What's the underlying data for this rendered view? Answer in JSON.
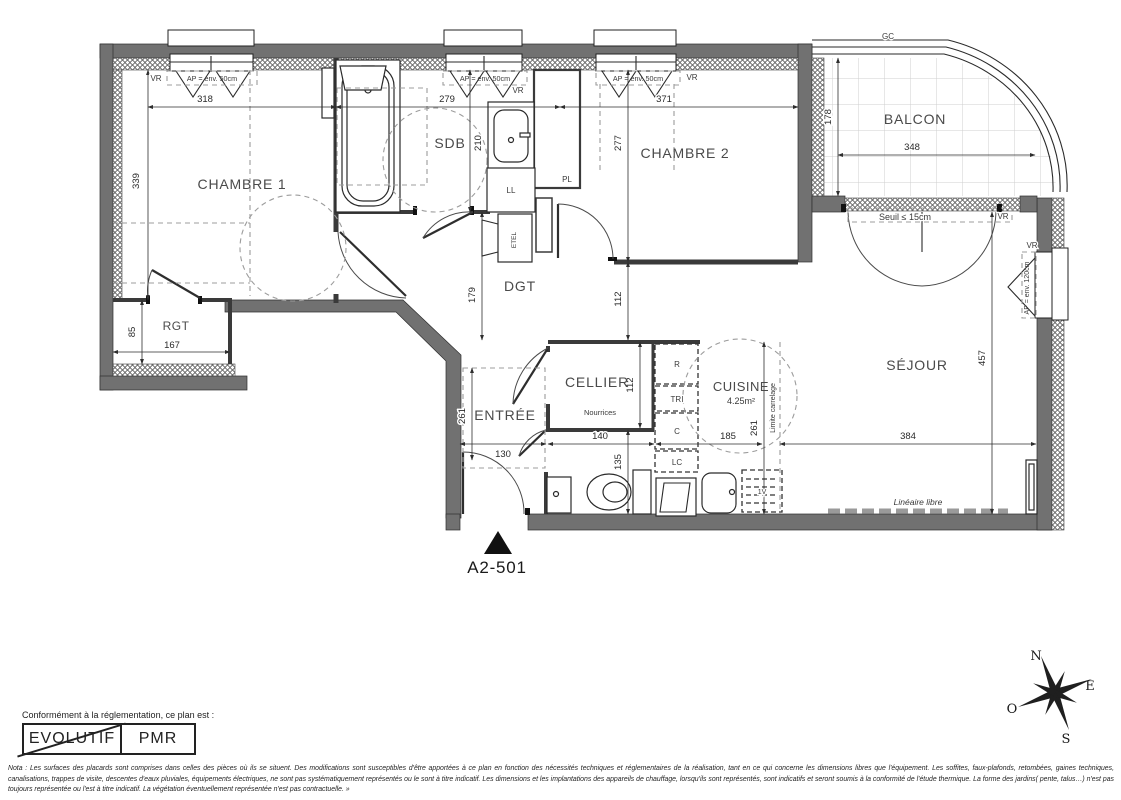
{
  "plan": {
    "unit": "A2-501",
    "rooms": {
      "chambre1": "CHAMBRE 1",
      "chambre2": "CHAMBRE 2",
      "sdb": "SDB",
      "dgt": "DGT",
      "rgt": "RGT",
      "entree": "ENTRÉE",
      "cellier": "CELLIER",
      "cuisine": "CUISINE",
      "cuisine_area": "4.25m²",
      "sejour": "SÉJOUR",
      "balcon": "BALCON"
    },
    "closets": {
      "ll": "LL",
      "pl": "PL",
      "etel": "ETEL",
      "r": "R",
      "tri": "TRI",
      "c": "C",
      "lc": "LC",
      "v": "1V"
    },
    "annotations": {
      "vr": "VR",
      "ap50": "AP = env. 50cm",
      "ap120": "AP = env. 120cm",
      "gc": "GC",
      "seuil": "Seuil ≤ 15cm",
      "nourrices": "Nourrices",
      "limite_carrelage": "Limite carrelage",
      "lineaire_libre": "Linéaire libre"
    },
    "dims": {
      "top_chambre1": "318",
      "top_sdb": "279",
      "top_chambre2": "371",
      "chambre1_h": "339",
      "sdb_h": "210",
      "chambre2_h": "277",
      "balcon_h": "178",
      "balcon_w": "348",
      "dgt_h": "179",
      "passage": "112",
      "rgt_h": "85",
      "rgt_w": "167",
      "entree_h": "261",
      "entree_w": "130",
      "cellier_w": "140",
      "cellier_h": "112",
      "wc_h": "135",
      "cuisine_w": "185",
      "cuisine_h": "261",
      "sejour_w": "384",
      "sejour_h": "457"
    },
    "compass": {
      "n": "N",
      "e": "E",
      "s": "S",
      "o": "O"
    }
  },
  "legend": {
    "title": "Conformément à la réglementation, ce plan est :",
    "evolutif": "EVOLUTIF",
    "pmr": "PMR"
  },
  "nota": "Nota : Les surfaces des placards sont comprises dans celles des pièces où ils se situent. Des modifications sont susceptibles d'être apportées à ce plan en fonction des nécessités techniques et réglementaires de la réalisation, tant en ce qui concerne les dimensions libres que l'équipement.  Les soffites, faux-plafonds, retombées, gaines techniques, canalisations, trappes de visite, descentes d'eaux pluviales, équipements électriques, ne sont pas systématiquement représentés ou le sont à titre indicatif. Les dimensions et les implantations des appareils de chauffage, lorsqu'ils sont représentés, sont indicatifs et seront soumis à la conformité de l'étude thermique. La forme des jardins( pente, talus…) n'est pas toujours représentée ou l'est à titre indicatif. La végétation éventuellement représentée n'est pas contractuelle. »",
  "colors": {
    "wall_gray": "#717171",
    "dash_gray": "#9c9c9c",
    "line_dark": "#1f1f1f"
  }
}
